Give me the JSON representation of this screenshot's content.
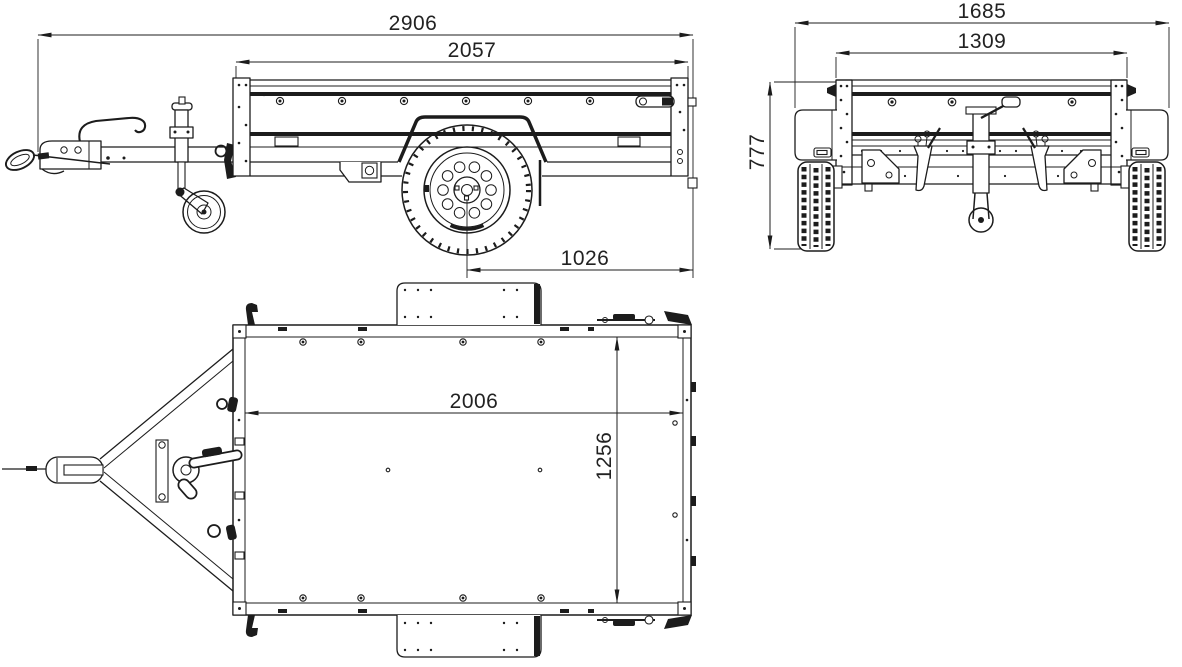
{
  "document": {
    "kind": "technical-dimensional-drawing",
    "subject": "Single-axle box trailer shown in side, rear and top orthographic views",
    "background_color": "#ffffff",
    "line_color": "#1c1c1c",
    "text_color": "#222222"
  },
  "views": {
    "side": {
      "label": "side-view",
      "dimensions": {
        "overall_length": "2906",
        "bed_length": "2057",
        "axle_to_rear": "1026"
      }
    },
    "rear": {
      "label": "rear-view",
      "dimensions": {
        "overall_width": "1685",
        "body_width": "1309",
        "overall_height": "777"
      }
    },
    "top": {
      "label": "top-view",
      "dimensions": {
        "inner_length": "2006",
        "inner_width": "1256"
      }
    }
  }
}
